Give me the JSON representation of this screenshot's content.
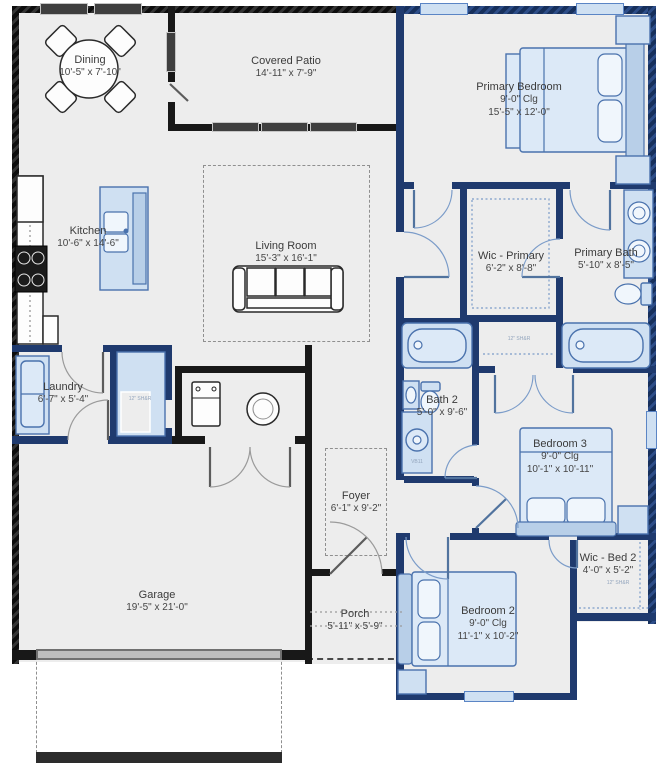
{
  "rooms": {
    "dining": {
      "name": "Dining",
      "dims": "10'-5\" x 7'-10\""
    },
    "covered_patio": {
      "name": "Covered Patio",
      "dims": "14'-11\" x 7'-9\""
    },
    "primary_bedroom": {
      "name": "Primary Bedroom",
      "ceiling": "9'-0\" Clg",
      "dims": "15'-5\" x 12'-0\""
    },
    "kitchen": {
      "name": "Kitchen",
      "dims": "10'-6\" x 14'-6\""
    },
    "living_room": {
      "name": "Living Room",
      "dims": "15'-3\" x 16'-1\""
    },
    "wic_primary": {
      "name": "Wic - Primary",
      "dims": "6'-2\" x 8'-8\""
    },
    "primary_bath": {
      "name": "Primary Bath",
      "dims": "5'-10\" x 8'-5\""
    },
    "laundry": {
      "name": "Laundry",
      "dims": "6'-7\" x 5'-4\""
    },
    "bath_2": {
      "name": "Bath 2",
      "dims": "5'-0\" x 9'-6\""
    },
    "bedroom_3": {
      "name": "Bedroom 3",
      "ceiling": "9'-0\" Clg",
      "dims": "10'-1\" x 10'-11\""
    },
    "foyer": {
      "name": "Foyer",
      "dims": "6'-1\" x 9'-2\""
    },
    "garage": {
      "name": "Garage",
      "dims": "19'-5\" x 21'-0\""
    },
    "porch": {
      "name": "Porch",
      "dims": "5'-11\" x 5'-9\""
    },
    "bedroom_2": {
      "name": "Bedroom 2",
      "ceiling": "9'-0\" Clg",
      "dims": "11'-1\" x 10'-2\""
    },
    "wic_bed_2": {
      "name": "Wic - Bed 2",
      "dims": "4'-0\" x 5'-2\"",
      "shelf_note": "12\" SH&R"
    }
  },
  "annotations": {
    "linen_note": "12\" SH&R",
    "closet_note": "12\" SH&R",
    "shower_note": "VB11"
  },
  "colors": {
    "wall_dark": "#181818",
    "wall_blue": "#1f3a6e",
    "floor": "#ededed",
    "furniture_fill": "#cfe0f2",
    "furniture_stroke": "#4a72ad",
    "window_blue": "#cfe0f2",
    "label_text": "#3b3b3b"
  }
}
